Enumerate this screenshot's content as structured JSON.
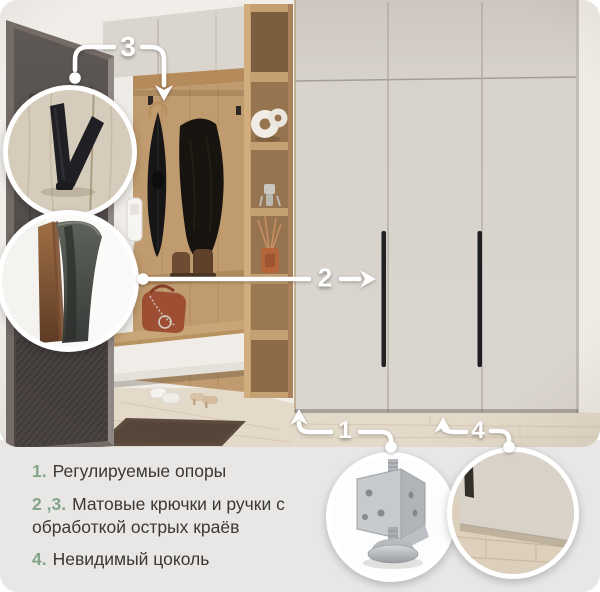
{
  "colors": {
    "green": "#84a489",
    "panel": "#e8e7e6",
    "ink": "#3b3835",
    "line": "#ffffff",
    "wood": "#c09b6f",
    "wardrobe": "#d7d2cb",
    "handle_black": "#222222"
  },
  "callouts": {
    "n1": "1",
    "n2": "2",
    "n3": "3",
    "n4": "4"
  },
  "legend": {
    "items": [
      {
        "num": "1.",
        "text": "Регулируемые опоры"
      },
      {
        "num": "2 ,3.",
        "text": "Матовые крючки и ручки с обработкой острых краёв"
      },
      {
        "num": "4.",
        "text": "Невидимый цоколь"
      }
    ]
  },
  "insets": {
    "hook": "matte-v-hook-closeup",
    "handle": "matte-handle-closeup",
    "foot": "adjustable-foot-closeup",
    "plinth": "invisible-plinth-closeup"
  }
}
